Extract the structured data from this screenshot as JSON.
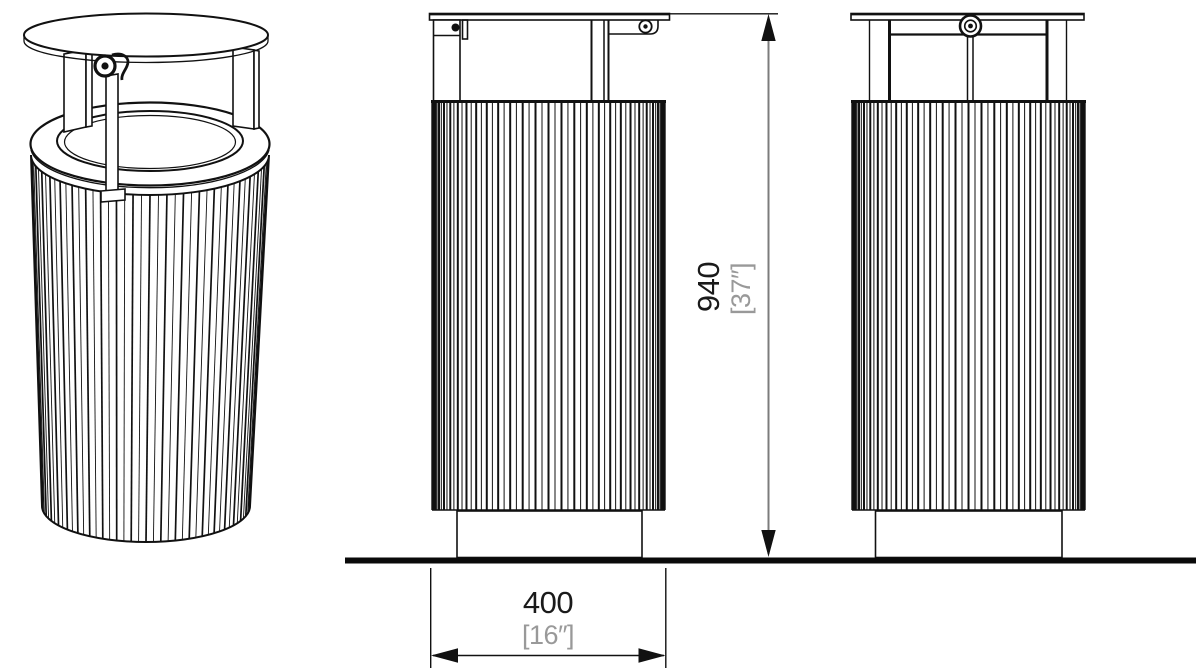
{
  "drawing": {
    "background": "#ffffff",
    "line_color": "#111111",
    "dim_line_color": "#7c7c7c",
    "labels": {
      "height_mm": "940",
      "height_in": "[37″]",
      "width_mm": "400",
      "width_in": "[16″]"
    },
    "label_colors": {
      "metric_text": "#1a1a1a",
      "imperial_text": "#999999"
    }
  }
}
